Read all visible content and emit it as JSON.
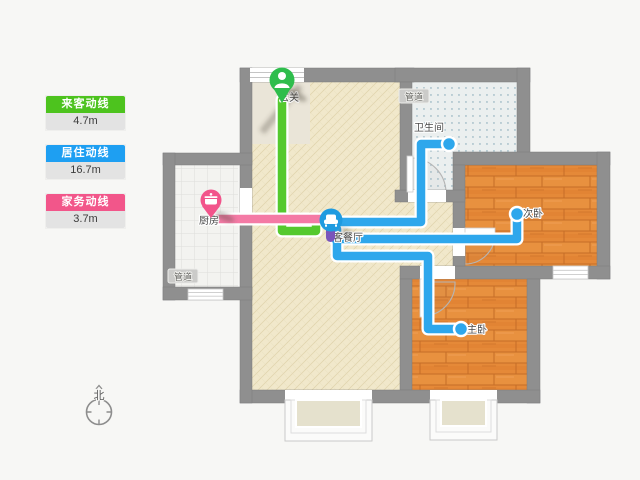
{
  "legend": {
    "items": [
      {
        "id": "guest",
        "label": "来客动线",
        "value": "4.7m",
        "color": "#4dc31e"
      },
      {
        "id": "living",
        "label": "居住动线",
        "value": "16.7m",
        "color": "#1e9ff2"
      },
      {
        "id": "chores",
        "label": "家务动线",
        "value": "3.7m",
        "color": "#f2568a"
      }
    ]
  },
  "plan": {
    "labels": {
      "entrance": "玄关",
      "pipe_top": "管道",
      "bathroom": "卫生间",
      "second_bedroom": "次卧",
      "living_dining": "客餐厅",
      "kitchen": "厨房",
      "pipe_kitchen": "管道",
      "master_bedroom": "主卧",
      "north": "北"
    },
    "markers": [
      {
        "id": "entrance-pin",
        "icon": "person-icon",
        "color": "#2ebd4c",
        "room": "玄关"
      },
      {
        "id": "kitchen-pin",
        "icon": "pot-icon",
        "color": "#f2548b",
        "room": "厨房"
      },
      {
        "id": "living-pin",
        "icon": "sofa-icon",
        "color": "#1f9be0",
        "room": "客餐厅"
      }
    ],
    "routes": [
      {
        "name": "来客动线",
        "length": "4.7m",
        "color": "#4dc31e",
        "stops": [
          "玄关",
          "客餐厅"
        ]
      },
      {
        "name": "居住动线",
        "length": "16.7m",
        "color": "#2ea7ec",
        "stops": [
          "客餐厅",
          "卫生间",
          "次卧",
          "主卧"
        ]
      },
      {
        "name": "家务动线",
        "length": "3.7m",
        "color": "#f47aa5",
        "stops": [
          "厨房",
          "客餐厅"
        ]
      }
    ]
  }
}
